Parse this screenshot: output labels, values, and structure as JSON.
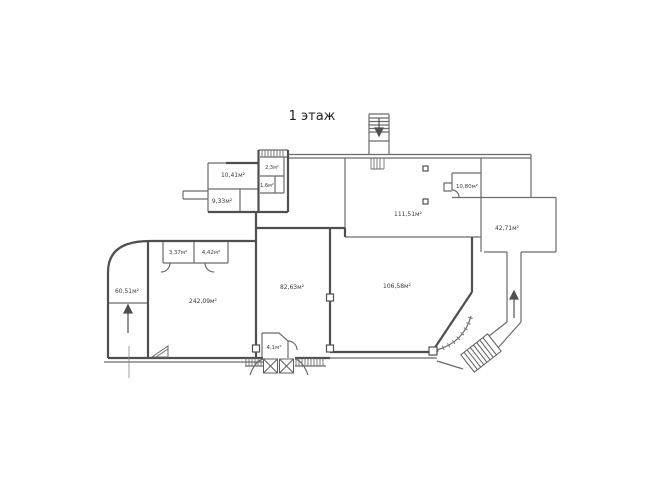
{
  "title": "1 этаж",
  "plan": {
    "rooms": {
      "top_left_large": "10,41м²",
      "top_left_small": "9,33м²",
      "wc_upper": "2,3м²",
      "wc_lower": "1,6м²",
      "hall_top_right": "111,51м²",
      "storage_top_right": "10,80м²",
      "room_far_right": "42,71м²",
      "room_left_rounded": "60,51м²",
      "closet_a": "3,37м²",
      "closet_b": "4,42м²",
      "hall_main": "242,09м²",
      "hall_center": "82,63м²",
      "hall_right": "106,58м²",
      "vestibule": "4,1м²"
    },
    "colors": {
      "line": "#6b6b6b",
      "line_dark": "#4f4f4f",
      "text": "#3c3c3c",
      "background": "#ffffff"
    }
  }
}
